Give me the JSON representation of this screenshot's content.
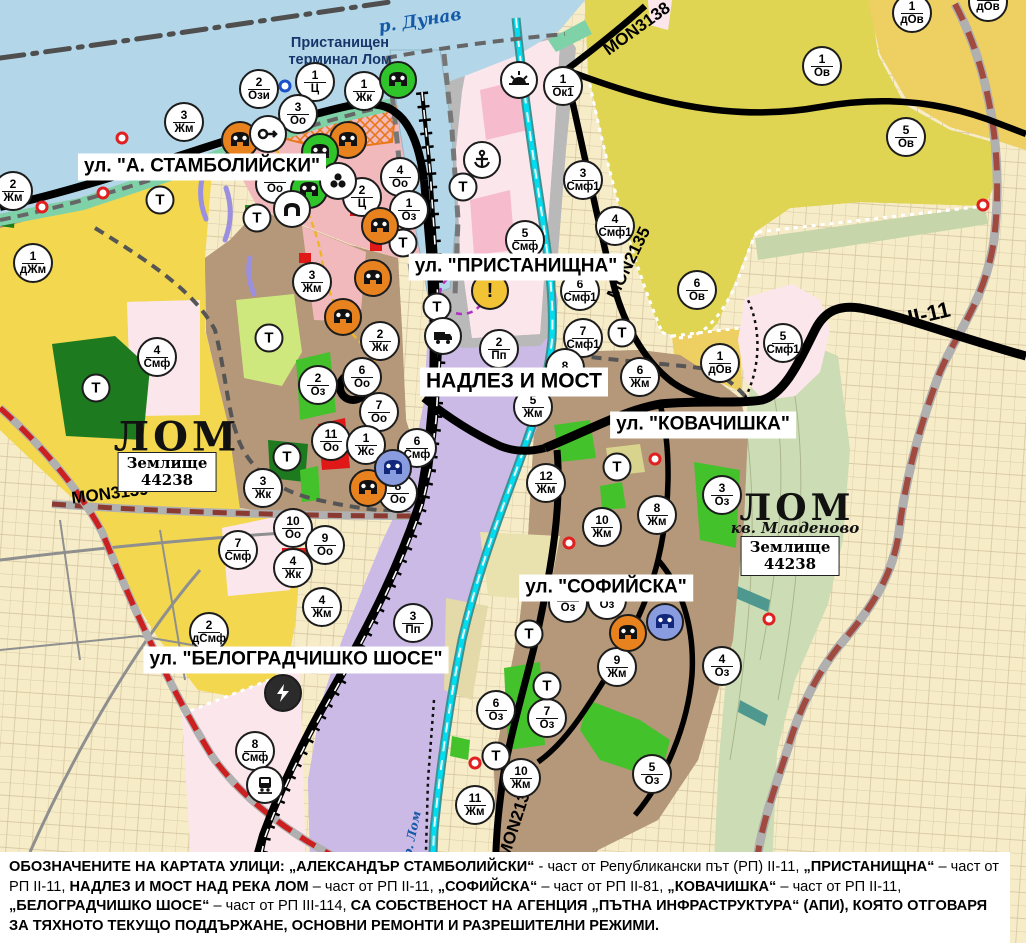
{
  "map": {
    "terminal_label": {
      "text": "Пристанищен\nтерминал Лом",
      "x": 340,
      "y": 52
    },
    "water_labels": [
      {
        "text": "р. Дунав",
        "x": 420,
        "y": 21,
        "rot": -9,
        "fs": 17
      },
      {
        "text": "р. Лом",
        "x": 412,
        "y": 834,
        "rot": -78,
        "fs": 12
      }
    ],
    "street_labels": [
      {
        "text": "ул. \"А. СТАМБОЛИЙСКИ\"",
        "x": 202,
        "y": 167,
        "fs": 19
      },
      {
        "text": "ул. \"ПРИСТАНИЩНА\"",
        "x": 516,
        "y": 267,
        "fs": 19
      },
      {
        "text": "НАДЛЕЗ И МОСТ",
        "x": 514,
        "y": 382,
        "fs": 21
      },
      {
        "text": "ул. \"КОВАЧИШКА\"",
        "x": 703,
        "y": 425,
        "fs": 19
      },
      {
        "text": "ул. \"СОФИЙСКА\"",
        "x": 606,
        "y": 588,
        "fs": 19
      },
      {
        "text": "ул. \"БЕЛОГРАДЧИШКО ШОСЕ\"",
        "x": 296,
        "y": 660,
        "fs": 19
      }
    ],
    "road_labels": [
      {
        "text": "MON3139",
        "x": 110,
        "y": 494,
        "rot": -7,
        "fs": 17
      },
      {
        "text": "MON3138",
        "x": 637,
        "y": 29,
        "rot": -36,
        "fs": 17
      },
      {
        "text": "MON2135",
        "x": 629,
        "y": 263,
        "rot": -64,
        "fs": 17
      },
      {
        "text": "MON2136",
        "x": 516,
        "y": 821,
        "rot": -72,
        "fs": 17
      },
      {
        "text": "II-11",
        "x": 929,
        "y": 314,
        "rot": -13,
        "fs": 22
      }
    ],
    "city_labels": [
      {
        "text": "ЛОМ",
        "x": 177,
        "y": 437,
        "fs": 40
      },
      {
        "text": "ЛОМ",
        "x": 797,
        "y": 508,
        "fs": 36
      }
    ],
    "city_subs": [
      {
        "text": "кв. Младеново",
        "x": 795,
        "y": 528,
        "fs": 15
      }
    ],
    "land_boxes": [
      {
        "text": "Землище\n44238",
        "x": 167,
        "y": 472
      },
      {
        "text": "Землище\n44238",
        "x": 790,
        "y": 556
      }
    ],
    "markers": {
      "transport_letter": "Т",
      "zones": [
        [
          259,
          89,
          "2",
          "Ози"
        ],
        [
          315,
          82,
          "1",
          "Ц"
        ],
        [
          364,
          91,
          "1",
          "Жк"
        ],
        [
          298,
          114,
          "3",
          "Оо"
        ],
        [
          184,
          122,
          "3",
          "Жм"
        ],
        [
          13,
          191,
          "2",
          "Жм"
        ],
        [
          33,
          263,
          "1",
          "дЖм"
        ],
        [
          400,
          177,
          "4",
          "Оо"
        ],
        [
          362,
          197,
          "2",
          "Ц"
        ],
        [
          409,
          210,
          "1",
          "Оз"
        ],
        [
          275,
          184,
          "",
          "Оо"
        ],
        [
          563,
          86,
          "1",
          "Ок1"
        ],
        [
          583,
          180,
          "3",
          "Смф1"
        ],
        [
          615,
          226,
          "4",
          "Смф1"
        ],
        [
          525,
          240,
          "5",
          "Смф"
        ],
        [
          822,
          66,
          "1",
          "Ов"
        ],
        [
          906,
          137,
          "5",
          "Ов"
        ],
        [
          912,
          13,
          "1",
          "дОв"
        ],
        [
          988,
          2,
          "",
          "дОв"
        ],
        [
          697,
          290,
          "6",
          "Ов"
        ],
        [
          720,
          363,
          "1",
          "дОв"
        ],
        [
          783,
          343,
          "5",
          "Смф1"
        ],
        [
          580,
          291,
          "6",
          "Смф1"
        ],
        [
          583,
          338,
          "7",
          "Смф1"
        ],
        [
          565,
          368,
          "8",
          ""
        ],
        [
          640,
          377,
          "6",
          "Жм"
        ],
        [
          533,
          407,
          "5",
          "Жм"
        ],
        [
          546,
          483,
          "12",
          "Жм"
        ],
        [
          602,
          527,
          "10",
          "Жм"
        ],
        [
          657,
          515,
          "8",
          "Жм"
        ],
        [
          722,
          495,
          "3",
          "Оз"
        ],
        [
          722,
          666,
          "4",
          "Оз"
        ],
        [
          312,
          282,
          "3",
          "Жм"
        ],
        [
          157,
          357,
          "4",
          "Смф"
        ],
        [
          318,
          385,
          "2",
          "Оз"
        ],
        [
          331,
          441,
          "11",
          "Оо"
        ],
        [
          263,
          488,
          "3",
          "Жк"
        ],
        [
          293,
          528,
          "10",
          "Оо"
        ],
        [
          325,
          545,
          "9",
          "Оо"
        ],
        [
          293,
          568,
          "4",
          "Жк"
        ],
        [
          322,
          607,
          "4",
          "Жм"
        ],
        [
          238,
          550,
          "7",
          "Смф"
        ],
        [
          209,
          632,
          "2",
          "дСмф"
        ],
        [
          255,
          751,
          "8",
          "Смф"
        ],
        [
          380,
          341,
          "2",
          "Жк"
        ],
        [
          362,
          377,
          "6",
          "Оо"
        ],
        [
          379,
          412,
          "7",
          "Оо"
        ],
        [
          366,
          445,
          "1",
          "Жс"
        ],
        [
          417,
          448,
          "6",
          "Смф"
        ],
        [
          398,
          493,
          "8",
          "Оо"
        ],
        [
          499,
          349,
          "2",
          "Пп"
        ],
        [
          413,
          623,
          "3",
          "Пп"
        ],
        [
          496,
          710,
          "6",
          "Оз"
        ],
        [
          547,
          718,
          "7",
          "Оз"
        ],
        [
          521,
          778,
          "10",
          "Жм"
        ],
        [
          475,
          805,
          "11",
          "Жм"
        ],
        [
          617,
          667,
          "9",
          "Жм"
        ],
        [
          652,
          774,
          "5",
          "Оз"
        ],
        [
          568,
          603,
          "",
          "Оз"
        ],
        [
          607,
          600,
          "",
          "Оз"
        ]
      ],
      "transport": [
        [
          160,
          200
        ],
        [
          257,
          218
        ],
        [
          403,
          243
        ],
        [
          463,
          187
        ],
        [
          437,
          307
        ],
        [
          622,
          333
        ],
        [
          269,
          338
        ],
        [
          96,
          388
        ],
        [
          287,
          457
        ],
        [
          617,
          467
        ],
        [
          529,
          634
        ],
        [
          547,
          686
        ],
        [
          496,
          756
        ]
      ],
      "poi": [
        [
          240,
          140,
          "mask-orange"
        ],
        [
          348,
          140,
          "mask-orange"
        ],
        [
          380,
          226,
          "mask-orange"
        ],
        [
          373,
          278,
          "mask-orange"
        ],
        [
          343,
          317,
          "mask-orange"
        ],
        [
          368,
          488,
          "mask-orange"
        ],
        [
          628,
          633,
          "mask-orange"
        ],
        [
          398,
          80,
          "mask-green"
        ],
        [
          320,
          152,
          "mask-green"
        ],
        [
          309,
          190,
          "mask-green"
        ],
        [
          393,
          468,
          "mask-blue"
        ],
        [
          665,
          622,
          "mask-blue"
        ],
        [
          268,
          134,
          "key"
        ],
        [
          338,
          181,
          "trefoil"
        ],
        [
          292,
          209,
          "arch"
        ],
        [
          482,
          160,
          "anchor"
        ],
        [
          519,
          80,
          "sun"
        ],
        [
          443,
          336,
          "truck"
        ],
        [
          490,
          291,
          "warn"
        ],
        [
          283,
          693,
          "lightning"
        ],
        [
          265,
          785,
          "train"
        ]
      ],
      "dots": [
        [
          122,
          138,
          "red"
        ],
        [
          103,
          193,
          "red"
        ],
        [
          42,
          207,
          "red"
        ],
        [
          655,
          459,
          "red"
        ],
        [
          569,
          543,
          "red"
        ],
        [
          475,
          763,
          "red"
        ],
        [
          769,
          619,
          "red"
        ],
        [
          983,
          205,
          "red"
        ],
        [
          285,
          86,
          "blue"
        ]
      ]
    }
  },
  "caption": {
    "segments": [
      {
        "t": "ОБОЗНАЧЕНИТЕ НА КАРТАТА УЛИЦИ: „АЛЕКСАНДЪР СТАМБОЛИЙСКИ“",
        "b": true
      },
      {
        "t": " - част от Републикански път (РП) II-11, ",
        "b": false
      },
      {
        "t": "„ПРИСТАНИЩНА“",
        "b": true
      },
      {
        "t": " – част от РП II-11, ",
        "b": false
      },
      {
        "t": "НАДЛЕЗ И МОСТ НАД РЕКА ЛОМ",
        "b": true
      },
      {
        "t": " – част от РП II-11, ",
        "b": false
      },
      {
        "t": "„СОФИЙСКА“",
        "b": true
      },
      {
        "t": " – част от РП II-81, ",
        "b": false
      },
      {
        "t": "„КОВАЧИШКА“",
        "b": true
      },
      {
        "t": " – част от РП II-11, ",
        "b": false
      },
      {
        "t": "„БЕЛОГРАДЧИШКО ШОСЕ“",
        "b": true
      },
      {
        "t": " – част от РП III-114, ",
        "b": false
      },
      {
        "t": "СА СОБСТВЕНОСТ НА АГЕНЦИЯ „ПЪТНА ИНФРАСТРУКТУРА“ (АПИ), КОЯТО ОТГОВАРЯ ЗА ТЯХНОТО ТЕКУЩО ПОДДЪРЖАНЕ, ОСНОВНИ РЕМОНТИ И РАЗРЕШИТЕЛНИ РЕЖИМИ.",
        "b": true
      }
    ]
  },
  "colors": {
    "water": "#b3d7e9",
    "shore": "#7fd2a8",
    "town_brown": "#b49879",
    "pink_central": "#f2b9bd",
    "purple_industry": "#cbb9e6",
    "gold_zone": "#f2d74f",
    "vine_zone": "#ded452",
    "dov_zone": "#eecf62",
    "smf_stripe": "#d41830",
    "green_oz": "#44c22c",
    "forest": "#1d7a1f",
    "sage_valley": "#ccdcb4",
    "farmland": "#f7ecc8",
    "river_cyan": "#00dcf0",
    "road_black": "#000000",
    "reddash_road": "#cc2020",
    "port_gray": "#b9b9b9"
  }
}
